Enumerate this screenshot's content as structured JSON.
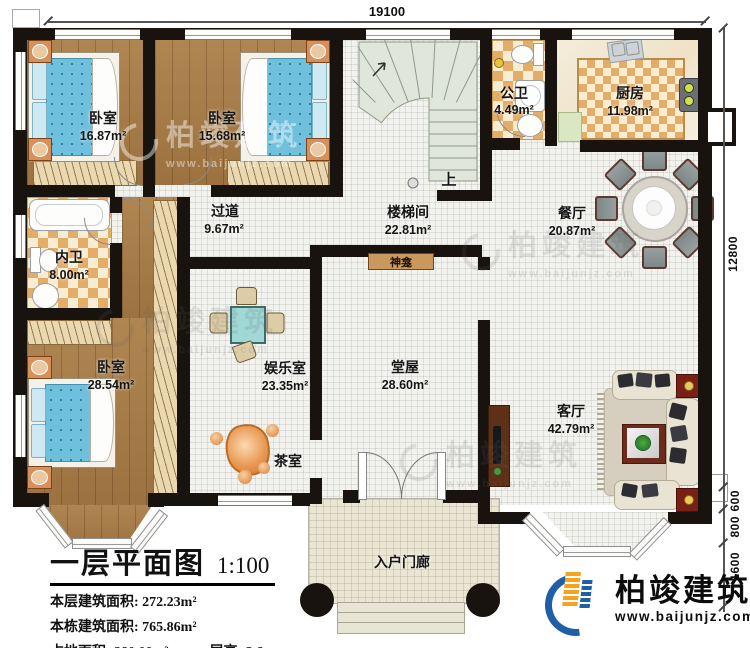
{
  "rooms": [
    {
      "name": "卧室",
      "area": "16.87m²"
    },
    {
      "name": "卧室",
      "area": "15.68m²"
    },
    {
      "name": "楼梯间",
      "area": "22.81m²"
    },
    {
      "name": "公卫",
      "area": "4.49m²"
    },
    {
      "name": "厨房",
      "area": "11.98m²"
    },
    {
      "name": "过道",
      "area": "9.67m²"
    },
    {
      "name": "餐厅",
      "area": "20.87m²"
    },
    {
      "name": "内卫",
      "area": "8.00m²"
    },
    {
      "name": "卧室",
      "area": "28.54m²"
    },
    {
      "name": "娱乐室",
      "area": "23.35m²"
    },
    {
      "name": "堂屋",
      "area": "28.60m²"
    },
    {
      "name": "客厅",
      "area": "42.79m²"
    },
    {
      "name": "茶室"
    },
    {
      "name": "入户门廊"
    }
  ],
  "annotations": {
    "shrine": "神龛",
    "stair_up": "上"
  },
  "dimensions": {
    "top_width": "19100",
    "right_height": "12800",
    "seg_600": "600",
    "seg_800": "800",
    "seg_1600": "1600"
  },
  "title_block": {
    "title": "一层平面图",
    "scale": "1:100",
    "line1_label": "本层建筑面积:",
    "line1_value": "272.23m²",
    "line2_label": "本栋建筑面积:",
    "line2_value": "765.86m²",
    "line3_label": "占地面积:",
    "line3_value": "280.00m²",
    "line4_label": "层高:",
    "line4_value": "3.6m"
  },
  "brand": {
    "logo_text": "柏竣建筑",
    "logo_url": "www.baijunjz.com",
    "blue": "#1e5fa8",
    "orange": "#f6a21c"
  },
  "watermark": {
    "text": "柏竣建筑",
    "url": "www.baijunjz.com"
  },
  "colors": {
    "wall": "#18130f",
    "wood": "#a97c45",
    "checker": "#e4ad67",
    "stair": "#e0e6d9"
  }
}
